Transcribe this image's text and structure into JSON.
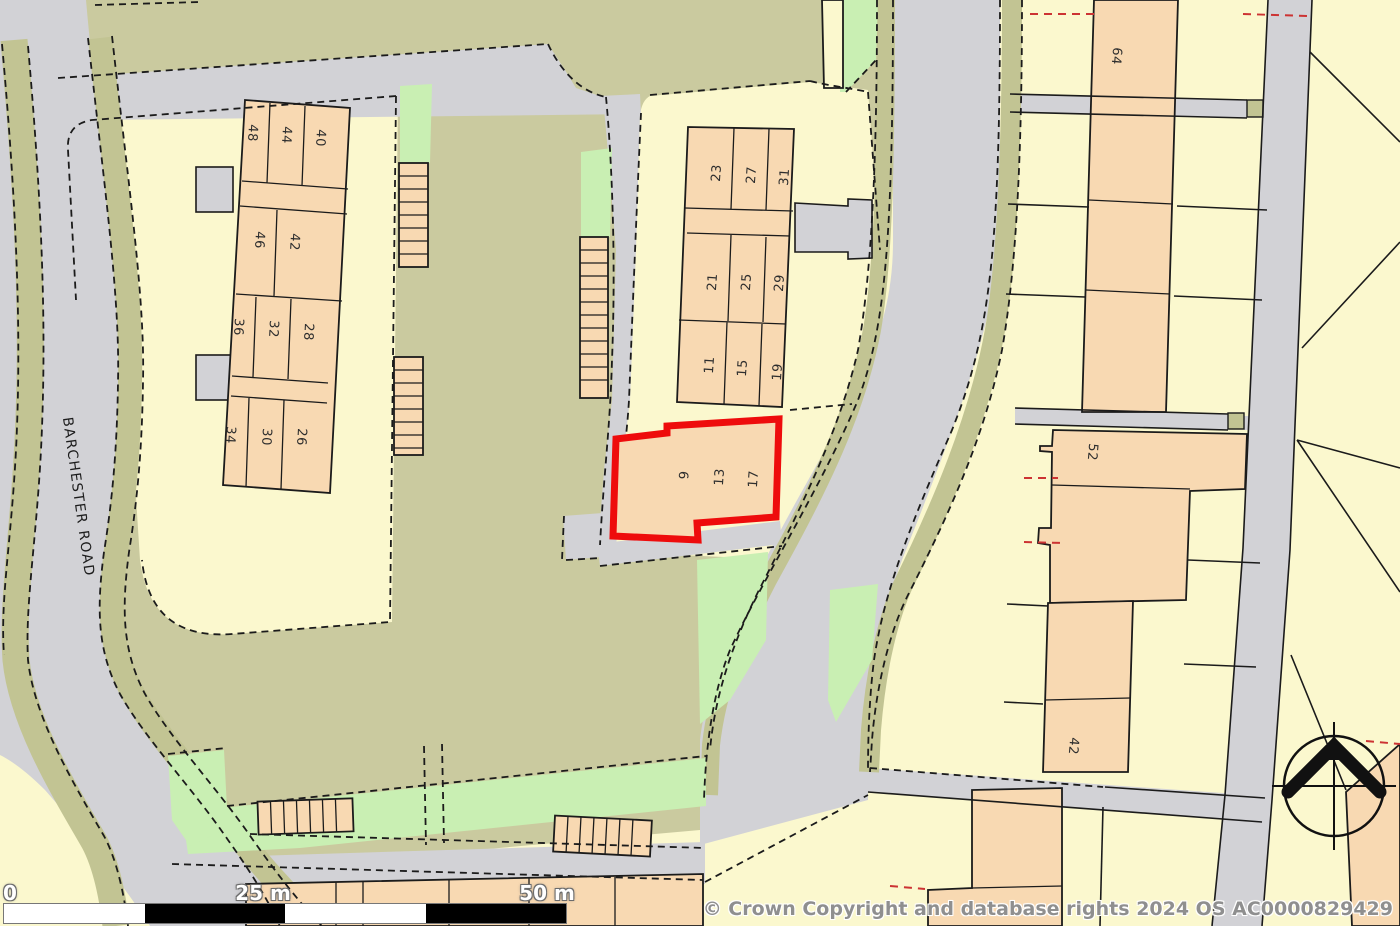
{
  "map": {
    "road_label": "BARCHESTER ROAD",
    "copyright_notice": "© Crown Copyright and database rights 2024 OS AC0000829429",
    "scale_bar": {
      "zero": "0",
      "mid": "25 m",
      "end": "50 m"
    },
    "highlight": {
      "plot_numbers": [
        "9",
        "13",
        "17"
      ],
      "outline_color": "#ee0c0c"
    },
    "house_numbers": {
      "west_terrace_row1": [
        "48",
        "44",
        "40"
      ],
      "west_terrace_row2": [
        "46",
        "42"
      ],
      "west_terrace_row3": [
        "36",
        "32",
        "28"
      ],
      "west_terrace_row4": [
        "34",
        "30",
        "26"
      ],
      "east_terrace_row1": [
        "23",
        "27",
        "31"
      ],
      "east_terrace_row2": [
        "21",
        "25",
        "29"
      ],
      "east_terrace_row3": [
        "11",
        "15",
        "19"
      ]
    },
    "east_column_numbers": {
      "n64": "64",
      "n52": "52",
      "n42": "42"
    },
    "palette": {
      "parcel_yellow": "#FBF8CE",
      "building_peach": "#F8D9B2",
      "road_grey": "#D2D2D6",
      "yard_khaki": "#CACA9F",
      "verge_olive": "#C2C493",
      "grass_green": "#C9EFB3",
      "boundary_black": "#1b1b1b",
      "red_dashed": "#CC3333",
      "highlight_red": "#EE0C0C"
    }
  }
}
